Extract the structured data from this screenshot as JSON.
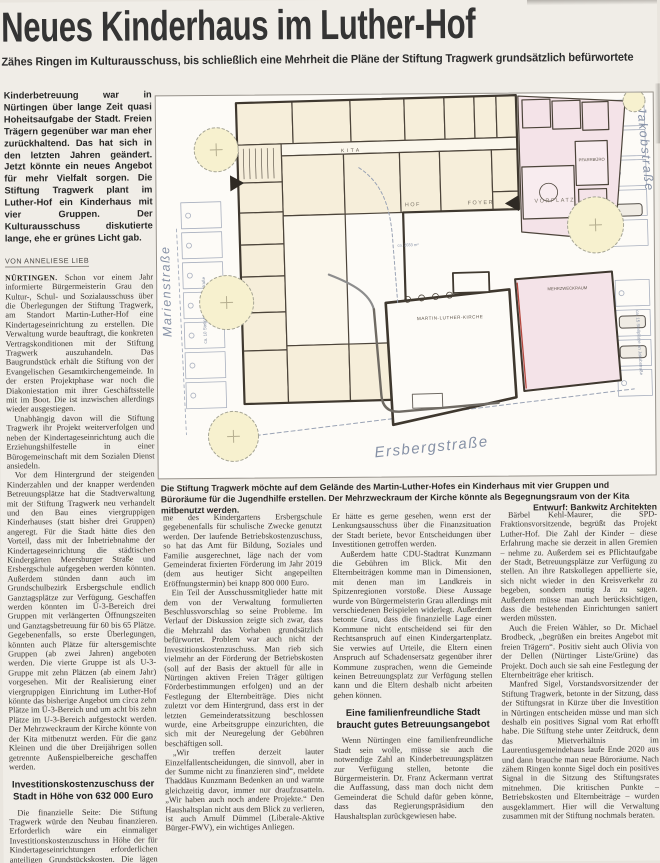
{
  "article": {
    "headline": "Neues Kinderhaus im Luther-Hof",
    "subheadline": "Zähes Ringen im Kulturausschuss, bis schließlich eine Mehrheit die Pläne der Stiftung Tragwerk grundsätzlich befürwortete",
    "lede": "Kinderbetreuung war in Nürtingen über lange Zeit quasi Hoheitsaufgabe der Stadt. Freien Trägern gegenüber war man eher zurückhaltend. Das hat sich in den letzten Jahren geändert. Jetzt könnte ein neues Angebot für mehr Vielfalt sorgen. Die Stiftung Tragwerk plant im Luther-Hof ein Kinderhaus mit vier Gruppen. Der Kulturausschuss diskutierte lange, ehe er grünes Licht gab.",
    "byline": "Von Anneliese Lieb",
    "col1": {
      "p1_label": "Nürtingen.",
      "p1_text": "Schon vor einem Jahr informierte Bürgermeisterin Grau den Kultur-, Schul- und Sozialausschuss über die Überlegungen der Stiftung Tragwerk, am Standort Martin-Luther-Hof eine Kindertageseinrichtung zu erstellen. Die Verwaltung wurde beauftragt, die konkreten Vertragskonditionen mit der Stiftung Tragwerk auszuhandeln. Das Baugrundstück erhält die Stiftung von der Evangelischen Gesamtkirchengemeinde. In der ersten Projektphase war noch die Diakoniestation mit ihrer Geschäftsstelle mit im Boot. Die ist inzwischen allerdings wieder ausgestiegen.",
      "p2": "Unabhängig davon will die Stiftung Tragwerk ihr Projekt weiterverfolgen und neben der Kindertageseinrichtung auch die Erziehungshilfestelle in einer Bürogemeinschaft mit dem Sozialen Dienst ansiedeln.",
      "p3": "Vor dem Hintergrund der steigenden Kinderzahlen und der knapper werdenden Betreuungsplätze hat die Stadtverwaltung mit der Stiftung Tragwerk neu verhandelt und den Bau eines viergruppigen Kinderhauses (statt bisher drei Gruppen) angeregt. Für die Stadt hätte dies den Vorteil, dass mit der Inbetriebnahme der Kindertageseinrichtung die städtischen Kindergärten Meersburger Straße und Ersbergschule aufgegeben werden könnten. Außerdem stünden dann auch im Grundschulbezirk Ersbergschule endlich Ganztagsplätze zur Verfügung. Geschaffen werden könnten im Ü-3-Bereich drei Gruppen mit verlängerten Öffnungszeiten und Ganztagsbetreuung für 60 bis 65 Plätze. Gegebenenfalls, so erste Überlegungen, könnten auch Plätze für altersgemischte Gruppen (ab zwei Jahren) angeboten werden. Die vierte Gruppe ist als U-3-Gruppe mit zehn Plätzen (ab einem Jahr) vorgesehen. Mit der Realisierung einer viergruppigen Einrichtung im Luther-Hof könnte das bisherige Angebot um circa zehn Plätze im Ü-3-Bereich und um acht bis zehn Plätze im U-3-Bereich aufgestockt werden. Der Mehrzweckraum der Kirche könnte von der Kita mitbenutzt werden. Für die ganz Kleinen und die über Dreijährigen sollen getrennte Außenspielbereiche geschaffen werden.",
      "subhead": "Investitionskostenzuschuss der Stadt in Höhe von 632 000 Euro",
      "p4": "Die finanzielle Seite: Die Stiftung Tragwerk würde den Neubau finanzieren. Erforderlich wäre ein einmaliger Investitionskostenzuschuss in Höhe der für Kindertageseinrichtungen erforderlichen anteiligen Grundstückskosten. Die lägen zuzüglich Grunderwerbsteuer bei 632 000 Euro. Von der Stadt könnte das Grundstück Meersburger Straße der Wohnbebauung zugeführt und die Räu-"
    },
    "col2": {
      "p1": "me des Kindergartens Ersbergschule gegebenenfalls für schulische Zwecke genutzt werden. Der laufende Betriebskostenzuschuss, so hat das Amt für Bildung, Soziales und Familie ausgerechnet, läge nach der vom Gemeinderat fixierten Förderung im Jahr 2019 (dem aus heutiger Sicht angepeilten Eröffnungstermin) bei knapp 800 000 Euro.",
      "p2": "Ein Teil der Ausschussmitglieder hatte mit dem von der Verwaltung formulierten Beschlussvorschlag so seine Probleme. Im Verlauf der Diskussion zeigte sich zwar, dass die Mehrzahl das Vorhaben grundsätzlich befürwortet. Problem war auch nicht der Investitionskostenzuschuss. Man rieb sich vielmehr an der Förderung der Betriebskosten (soll auf der Basis der aktuell für alle in Nürtingen aktiven Freien Träger gültigen Förderbestimmungen erfolgen) und an der Festlegung der Elternbeiträge. Dies nicht zuletzt vor dem Hintergrund, dass erst in der letzten Gemeinderatssitzung beschlossen wurde, eine Arbeitsgruppe einzurichten, die sich mit der Neuregelung der Gebühren beschäftigen soll.",
      "p3": "„Wir treffen derzeit lauter Einzelfallentscheidungen, die sinnvoll, aber in der Summe nicht zu finanzieren sind“, meldete Thaddäus Kunzmann Bedenken an und warnte gleichzeitig davor, immer nur draufzusatteln. „Wir haben auch noch andere Projekte.“ Den Haushaltsplan nicht aus dem Blick zu verlieren, ist auch Arnulf Dümmel (Liberale-Aktive Bürger-FWV), ein wichtiges Anliegen."
    },
    "col3": {
      "p1": "Er hätte es gerne gesehen, wenn erst der Lenkungsausschuss über die Finanzsituation der Stadt beriete, bevor Entscheidungen über Investitionen getroffen werden.",
      "p2": "Außerdem hatte CDU-Stadtrat Kunzmann die Gebühren im Blick. Mit den Elternbeiträgen komme man in Dimensionen, mit denen man im Landkreis in Spitzenregionen vorstoße. Diese Aussage wurde von Bürgermeisterin Grau allerdings mit verschiedenen Beispielen widerlegt. Außerdem betonte Grau, dass die finanzielle Lage einer Kommune nicht entscheidend sei für den Rechtsanspruch auf einen Kindergartenplatz. Sie verwies auf Urteile, die Eltern einen Anspruch auf Schadensersatz gegenüber ihrer Kommune zusprachen, wenn die Gemeinde keinen Betreuungsplatz zur Verfügung stellen kann und die Eltern deshalb nicht arbeiten gehen können.",
      "subhead": "Eine familienfreundliche Stadt braucht gutes Betreuungsangebot",
      "p3": "Wenn Nürtingen eine familienfreundliche Stadt sein wolle, müsse sie auch die notwendige Zahl an Kinderbetreuungsplätzen zur Verfügung stellen, betonte die Bürgermeisterin. Dr. Franz Ackermann vertrat die Auffassung, dass man doch nicht dem Gemeinderat die Schuld dafür geben könne, dass das Regierungspräsidium den Haushaltsplan zurückgewiesen habe."
    },
    "col4": {
      "p1": "Bärbel Kehl-Maurer, die SPD-Fraktionsvorsitzende, begrüßt das Projekt Luther-Hof. Die Zahl der Kinder – diese Erfahrung mache sie derzeit in allen Gremien – nehme zu. Außerdem sei es Pflichtaufgabe der Stadt, Betreuungsplätze zur Verfügung zu stellen. An ihre Ratskollegen appellierte sie, sich nicht wieder in den Kreisverkehr zu begeben, sondern mutig Ja zu sagen. Außerdem müsse man auch berücksichtigen, dass die bestehenden Einrichtungen saniert werden müssten.",
      "p2": "Auch die Freien Wähler, so Dr. Michael Brodbeck, „begrüßen ein breites Angebot mit freien Trägern“. Positiv sieht auch Olivia von der Dellen (Nürtinger Liste/Grüne) das Projekt. Doch auch sie sah eine Festlegung der Elternbeiträge eher kritisch.",
      "p3": "Manfred Sigel, Vorstandsvorsitzender der Stiftung Tragwerk, betonte in der Sitzung, dass der Stiftungsrat in Kürze über die Investition in Nürtingen entscheiden müsse und man sich deshalb ein positives Signal vom Rat erhofft habe. Die Stiftung stehe unter Zeitdruck, denn das Mietverhältnis im Laurentiusgemeindehaus laufe Ende 2020 aus und dann brauche man neue Büroräume. Nach zähem Ringen konnte Sigel doch ein positives Signal in die Sitzung des Stiftungsrates mitnehmen. Die kritischen Punkte – Betriebskosten und Elternbeiträge – wurden ausgeklammert. Hier will die Verwaltung zusammen mit der Stiftung nochmals beraten."
    },
    "caption": {
      "text": "Die Stiftung Tragwerk möchte auf dem Gelände des Martin-Luther-Hofes ein Kinderhaus mit vier Gruppen und Büroräume für die Jugendhilfe erstellen. Der Mehrzweckraum der Kirche könnte als Begegnungsraum von der Kita mitbenutzt werden.",
      "credit": "Entwurf: Bankwitz Architekten"
    }
  },
  "plan": {
    "labels": {
      "street_left": "Marienstraße",
      "street_right": "Jakobstraße",
      "street_bottom": "Ersbergstraße",
      "parking_left": "ca. 10 Stellplätze an Marienstraße",
      "parking_right": "ca. 15 Stellplätze an Jakobstraße",
      "kita": "KITA",
      "hof": "HOF",
      "hof_area": "ca. 2033 m²",
      "foyer": "FOYER",
      "vorplatz": "VORPLATZ",
      "pfarrbuero": "PFARRBÜRO",
      "mehrzweckraum": "MEHRZWECKRAUM",
      "kirche": "MARTIN-LUTHER-KIRCHE"
    },
    "colors": {
      "room_fill": "#f6eeda",
      "church_fill": "#f4e3e8",
      "tree_fill": "#f7f1cf",
      "outline": "#4c443a",
      "street_label": "#8691a6",
      "red_accent": "#b5493f"
    }
  }
}
